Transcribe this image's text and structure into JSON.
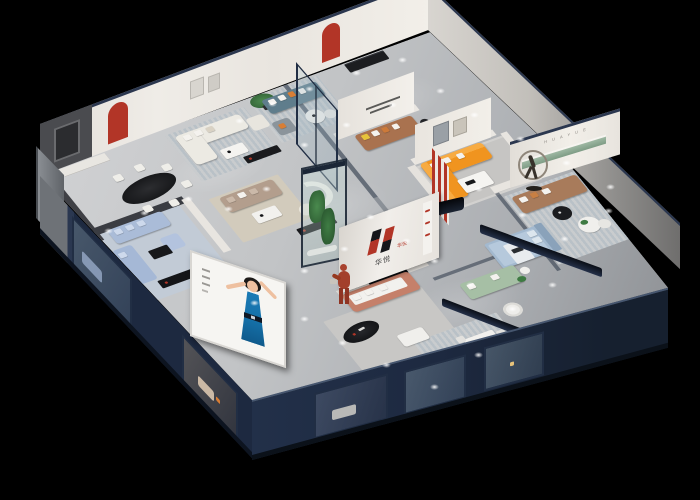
{
  "scene": {
    "description": "Isometric cutaway 3D render of a furniture showroom at night",
    "background": "#000000"
  },
  "brand": {
    "logo_text": "华悦",
    "logo_text_mini": "华悦",
    "wall_letters": "H U A Y U E"
  },
  "palette": {
    "bg": "#000000",
    "floor": "#c2c4c6",
    "floor-dark": "#9ba0a4",
    "wall-white": "#ece9e3",
    "wall-dark": "#45464b",
    "navy": "#1d2940",
    "navy-light": "#33425e",
    "red": "#b23527",
    "orange": "#f0941f",
    "blue-sofa": "#aabcd8",
    "teal-sofa": "#5f7d8c",
    "taupe-sofa": "#b39e8d",
    "cream-sofa": "#eceae3",
    "tan-sofa": "#a87b5b",
    "cognac-sofa": "#a9724f",
    "salmon-sofa": "#c5806a",
    "sage-sofa": "#a6bfa5",
    "bed-blue": "#a3b9cf",
    "green": "#3e7a42",
    "rug-stripe-a": "#c9ccce",
    "rug-stripe-b": "#b9c1c7",
    "rug-beige": "#d2cbbc",
    "black": "#17181a",
    "dress-blue": "#1570a8",
    "skin": "#eec0a0",
    "bronze": "#8f867a",
    "sage-shelf": "#9eb8a3"
  },
  "elements": [
    "back-wall-red-arch-niches",
    "dark-feature-wall",
    "oval-dining-table",
    "dining-chairs",
    "cream-lounge-set",
    "potted-tree",
    "teal-sofa-set",
    "cognac-leather-sofa",
    "wall-quote-text",
    "entry-glass-door",
    "plant-display-case",
    "reception-counter",
    "terracotta-mannequin",
    "brand-logo-wall",
    "orange-sectional-sofa",
    "red-ribbon-wall-feature",
    "bronze-runner-sculpture",
    "huayue-letter-wall",
    "green-wall-shelf",
    "tan-leather-sofa",
    "round-coffee-tables",
    "blue-fabric-bed",
    "sage-green-sofa",
    "light-blue-sectional",
    "taupe-sofa-set",
    "curved-partition",
    "salmon-sofa-set",
    "black-oval-coffee-table",
    "white-ottoman",
    "grey-sofa",
    "white-dining-set",
    "tv-bench",
    "facade-ad-screen",
    "ad-screen-model",
    "glass-partition-rails",
    "downlight-glows"
  ]
}
